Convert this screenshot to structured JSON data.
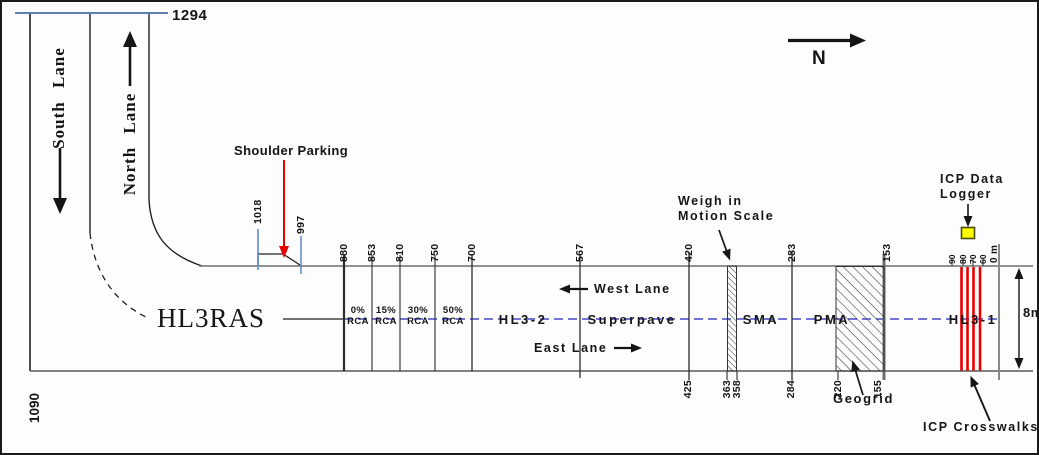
{
  "compass": {
    "label": "N"
  },
  "approach_road": {
    "south_lane_label": "South Lane",
    "north_lane_label": "North Lane",
    "north_end_station": "1294",
    "south_end_station": "1090"
  },
  "shoulder_parking": {
    "label": "Shoulder Parking",
    "stations": [
      {
        "value": "1018",
        "x": 256,
        "cy": 200,
        "w": 44
      },
      {
        "value": "997",
        "x": 299,
        "cy": 214,
        "w": 36
      }
    ]
  },
  "mainline": {
    "hl3ras_label": "HL3RAS",
    "west_lane_label": "West Lane",
    "east_lane_label": "East Lane",
    "road_width_label": "8m",
    "zero_station": {
      "value": "0 m",
      "x": 993,
      "cy": 246,
      "w": 30
    },
    "sections": [
      {
        "label": "HL3-2",
        "cx": 521
      },
      {
        "label": "Superpave",
        "cx": 630
      },
      {
        "label": "SMA",
        "cx": 759
      },
      {
        "label": "PMA",
        "cx": 830
      },
      {
        "label": "HL3-1",
        "cx": 971
      }
    ],
    "rca_sections": [
      {
        "percent": "0%",
        "material": "RCA",
        "cx": 356
      },
      {
        "percent": "15%",
        "material": "RCA",
        "cx": 384
      },
      {
        "percent": "30%",
        "material": "RCA",
        "cx": 416
      },
      {
        "percent": "50%",
        "material": "RCA",
        "cx": 451
      }
    ],
    "top_stations": [
      {
        "value": "880",
        "x": 342
      },
      {
        "value": "853",
        "x": 370
      },
      {
        "value": "810",
        "x": 398
      },
      {
        "value": "750",
        "x": 433
      },
      {
        "value": "700",
        "x": 470
      },
      {
        "value": "567",
        "x": 578
      },
      {
        "value": "420",
        "x": 687
      },
      {
        "value": "283",
        "x": 790
      },
      {
        "value": "153",
        "x": 885
      }
    ],
    "bottom_stations": [
      {
        "value": "425",
        "x": 686
      },
      {
        "value": "363",
        "x": 725
      },
      {
        "value": "358",
        "x": 735
      },
      {
        "value": "284",
        "x": 789
      },
      {
        "value": "220",
        "x": 836
      },
      {
        "value": "155",
        "x": 876
      }
    ],
    "crosswalk_stations": [
      {
        "value": "90",
        "x": 950
      },
      {
        "value": "80",
        "x": 961
      },
      {
        "value": "70",
        "x": 971
      },
      {
        "value": "60",
        "x": 981
      }
    ]
  },
  "features": {
    "weigh_in_motion": {
      "line1": "Weigh in",
      "line2": "Motion Scale"
    },
    "icp_data_logger": {
      "line1": "ICP Data",
      "line2": "Logger"
    },
    "geogrid": {
      "label": "Geogrid"
    },
    "icp_crosswalks": {
      "label": "ICP Crosswalks"
    }
  },
  "colors": {
    "centerline_blue": "#4646c8",
    "crosswalk_red": "#e60000",
    "parking_tick_blue": "#5b87c5",
    "logger_yellow": "#ffff00",
    "north_limit_blue": "#5b7fb5"
  }
}
